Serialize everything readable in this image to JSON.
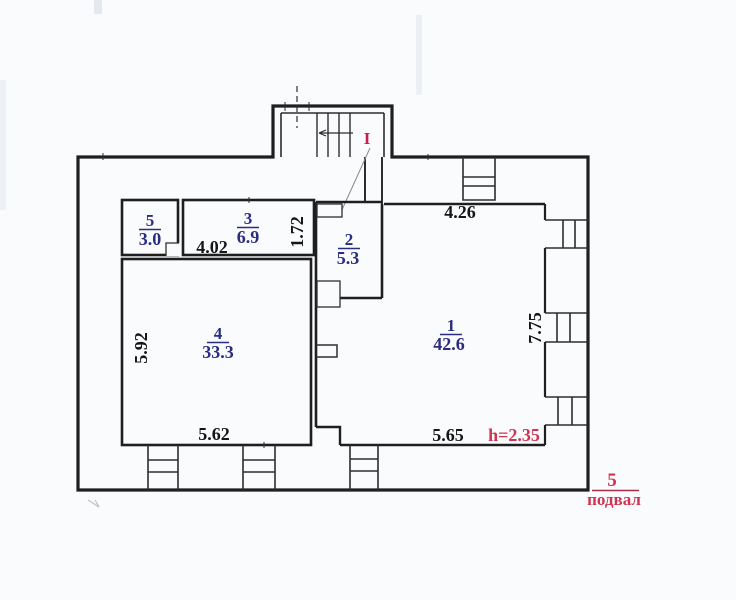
{
  "drawing": {
    "type": "floor-plan-scan",
    "floor": {
      "number": "5",
      "name": "подвал"
    },
    "notes": {
      "ceiling_height": "h=2.35",
      "stair_mark": "I"
    },
    "rooms": [
      {
        "number": "1",
        "area": "42.6"
      },
      {
        "number": "2",
        "area": "5.3"
      },
      {
        "number": "3",
        "area": "6.9"
      },
      {
        "number": "4",
        "area": "33.3"
      },
      {
        "number": "5",
        "area": "3.0"
      }
    ],
    "dimensions": {
      "room1_top_width": "4.26",
      "room1_bottom_width": "5.65",
      "room1_height": "7.75",
      "room3_width": "4.02",
      "room3_depth": "1.72",
      "room4_width": "5.62",
      "room4_height": "5.92"
    },
    "colors": {
      "room_number": "#2b2d80",
      "dimension_text": "#161616",
      "red_label": "#cf3552",
      "wall": "#1f1f1f"
    }
  }
}
